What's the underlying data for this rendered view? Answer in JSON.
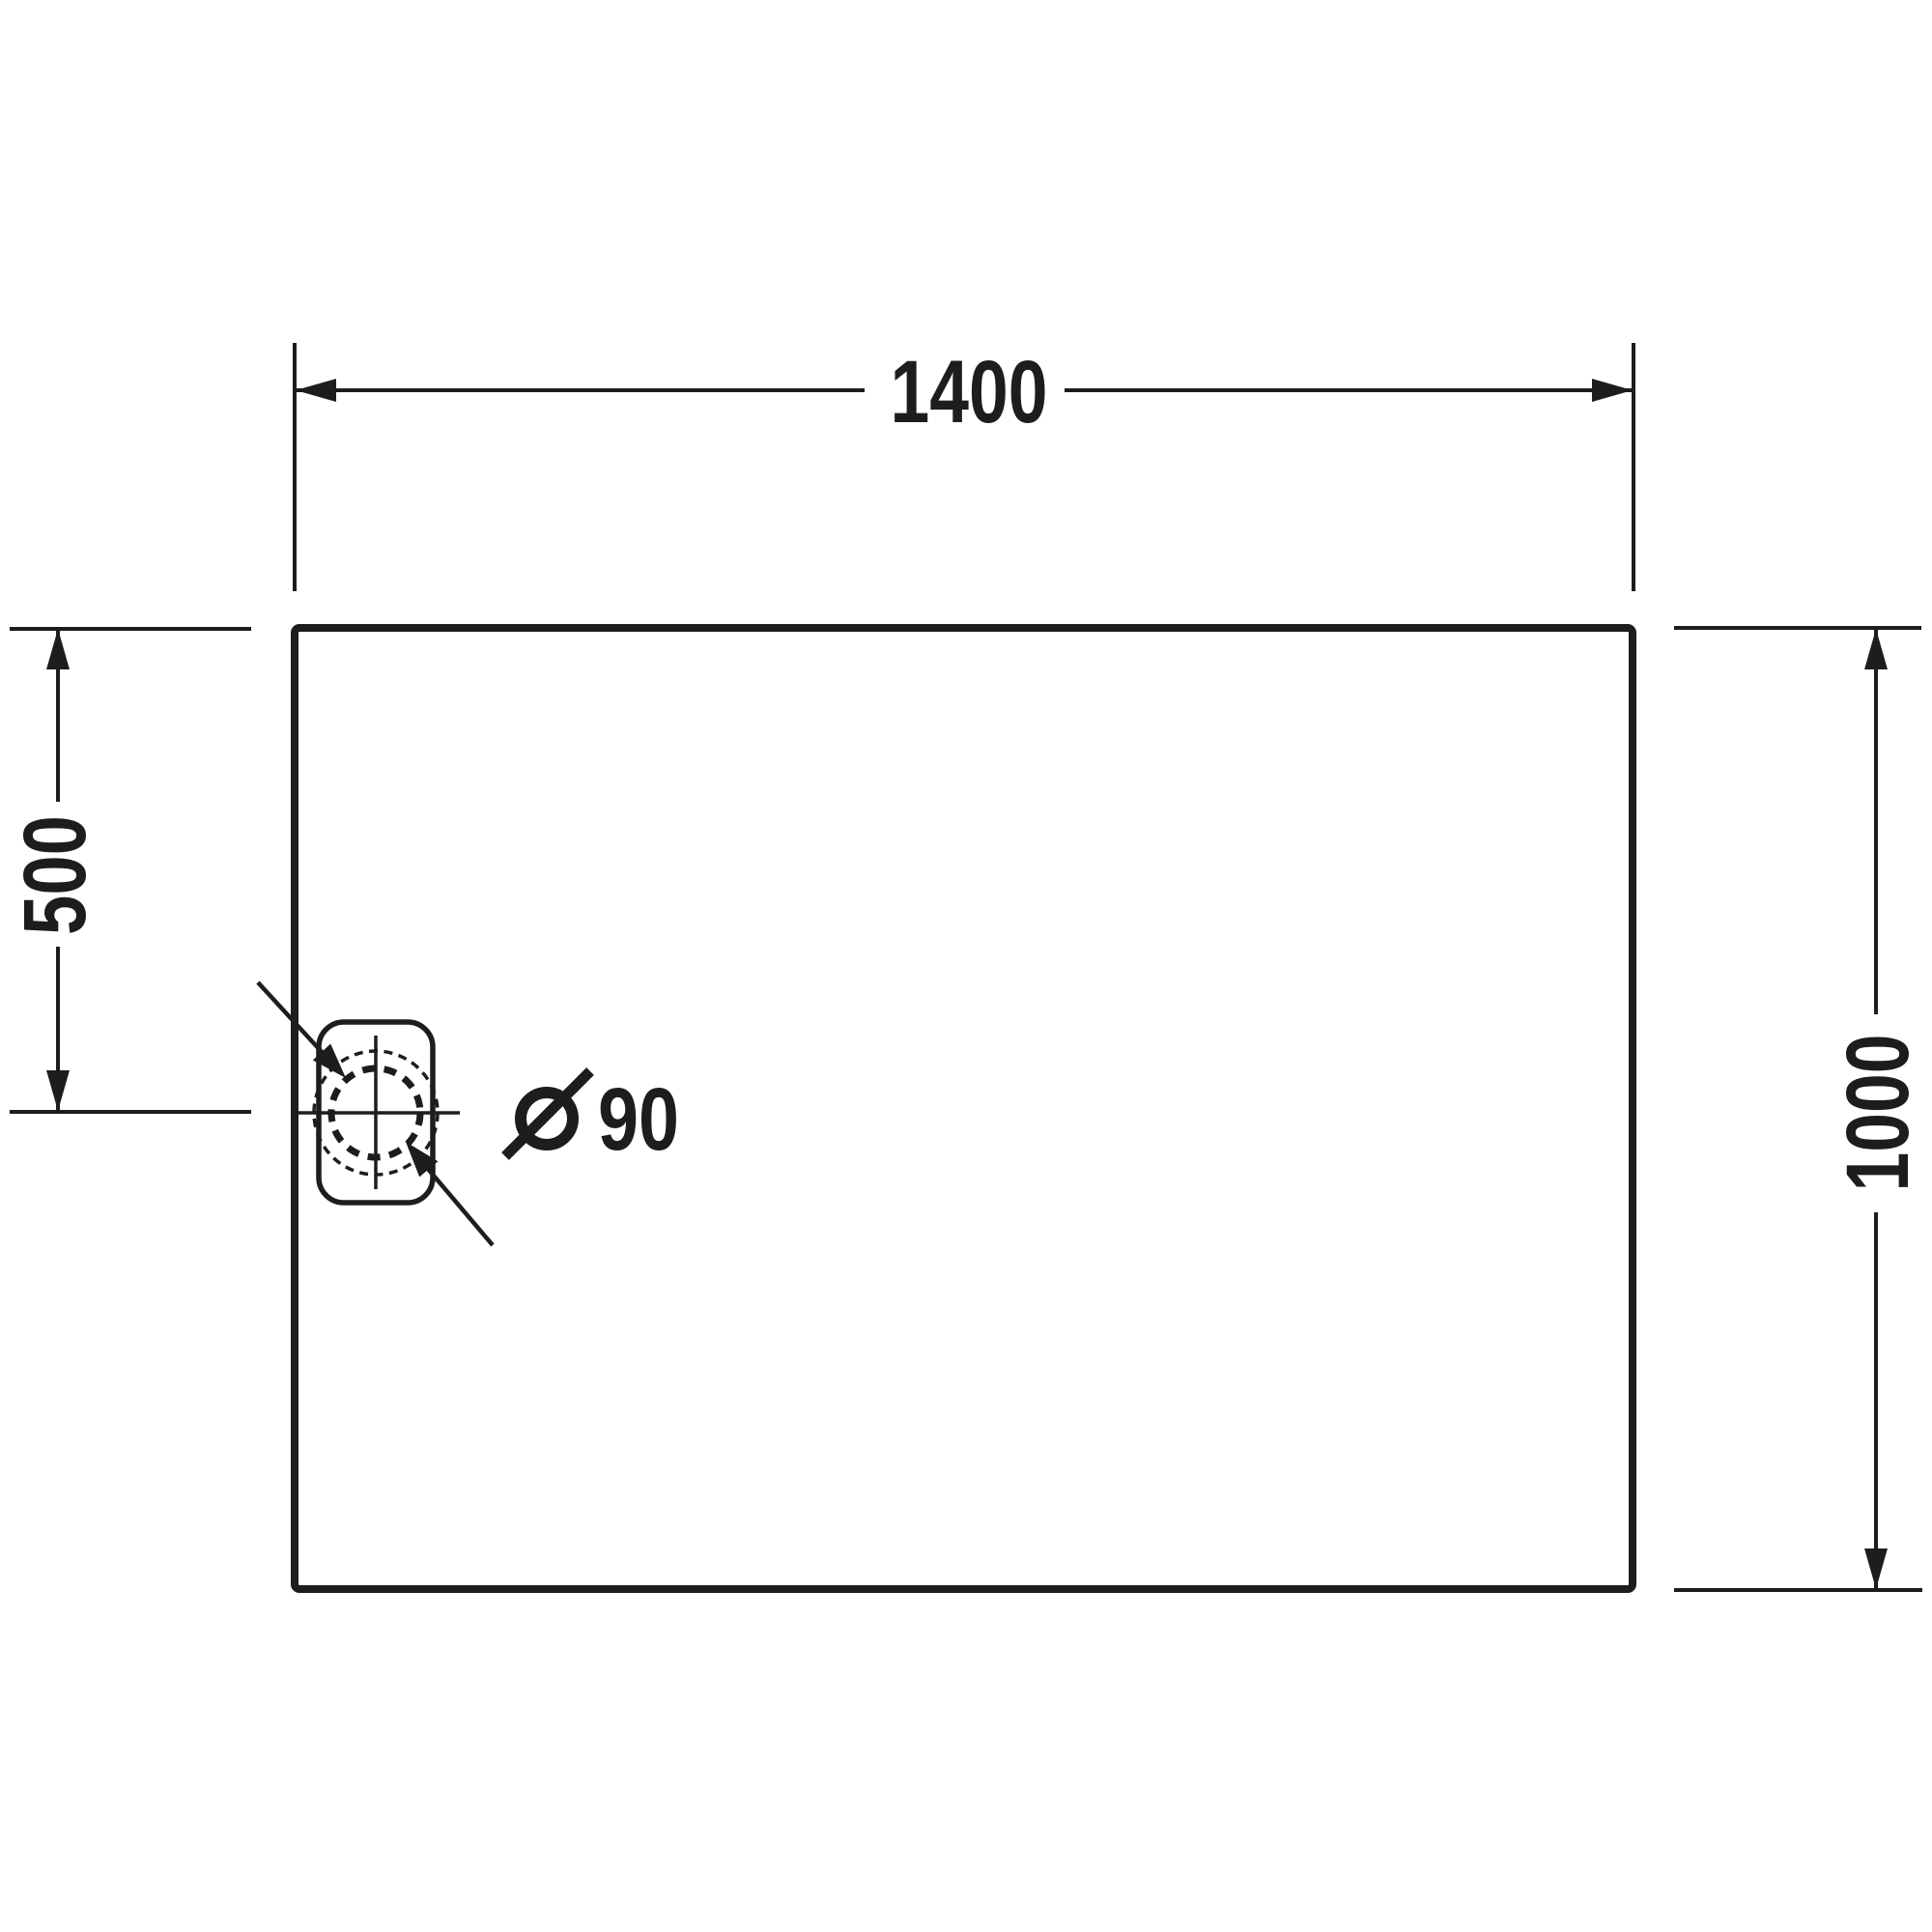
{
  "drawing": {
    "background_color": "#ffffff",
    "line_color": "#1d1d1b",
    "labels": {
      "width": "1400",
      "drain_offset": "500",
      "depth": "1000",
      "drain_diameter_symbol": "Ø",
      "drain_diameter_value": "90",
      "drain_diameter_full": "Ø 90"
    }
  }
}
